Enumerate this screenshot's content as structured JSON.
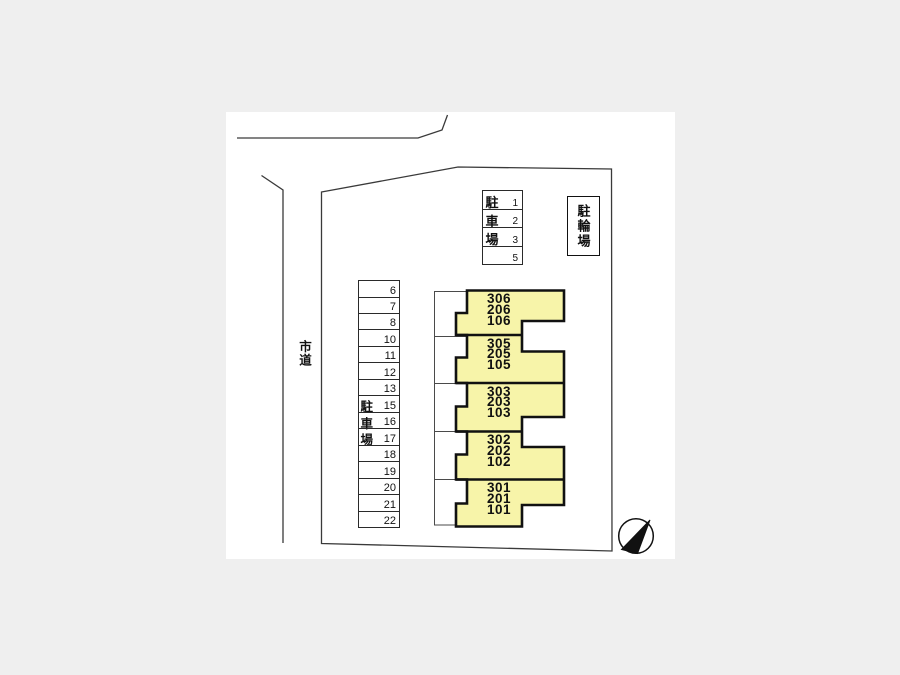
{
  "colors": {
    "background": "#efefef",
    "paper": "#ffffff",
    "building_fill": "#f7f4a9",
    "thin_line": "#3a3a3a",
    "thick_line": "#111111"
  },
  "labels": {
    "road": "市道",
    "bike_shed": "駐輪場",
    "parking_lot": "駐車場"
  },
  "parking_top": {
    "rows": [
      {
        "kanji": "駐",
        "num": "1"
      },
      {
        "kanji": "車",
        "num": "2"
      },
      {
        "kanji": "場",
        "num": "3"
      },
      {
        "kanji": "",
        "num": "5"
      }
    ]
  },
  "parking_left": {
    "stalls": [
      {
        "num": "6",
        "kanji": ""
      },
      {
        "num": "7",
        "kanji": ""
      },
      {
        "num": "8",
        "kanji": ""
      },
      {
        "num": "10",
        "kanji": ""
      },
      {
        "num": "11",
        "kanji": ""
      },
      {
        "num": "12",
        "kanji": ""
      },
      {
        "num": "13",
        "kanji": ""
      },
      {
        "num": "15",
        "kanji": "駐"
      },
      {
        "num": "16",
        "kanji": "車"
      },
      {
        "num": "17",
        "kanji": "場"
      },
      {
        "num": "18",
        "kanji": ""
      },
      {
        "num": "19",
        "kanji": ""
      },
      {
        "num": "20",
        "kanji": ""
      },
      {
        "num": "21",
        "kanji": ""
      },
      {
        "num": "22",
        "kanji": ""
      }
    ]
  },
  "building": {
    "units": [
      {
        "lines": [
          "306",
          "206",
          "106"
        ]
      },
      {
        "lines": [
          "305",
          "205",
          "105"
        ]
      },
      {
        "lines": [
          "303",
          "203",
          "103"
        ]
      },
      {
        "lines": [
          "302",
          "202",
          "102"
        ]
      },
      {
        "lines": [
          "301",
          "201",
          "101"
        ]
      }
    ]
  },
  "icons": {
    "compass": "north-arrow"
  }
}
